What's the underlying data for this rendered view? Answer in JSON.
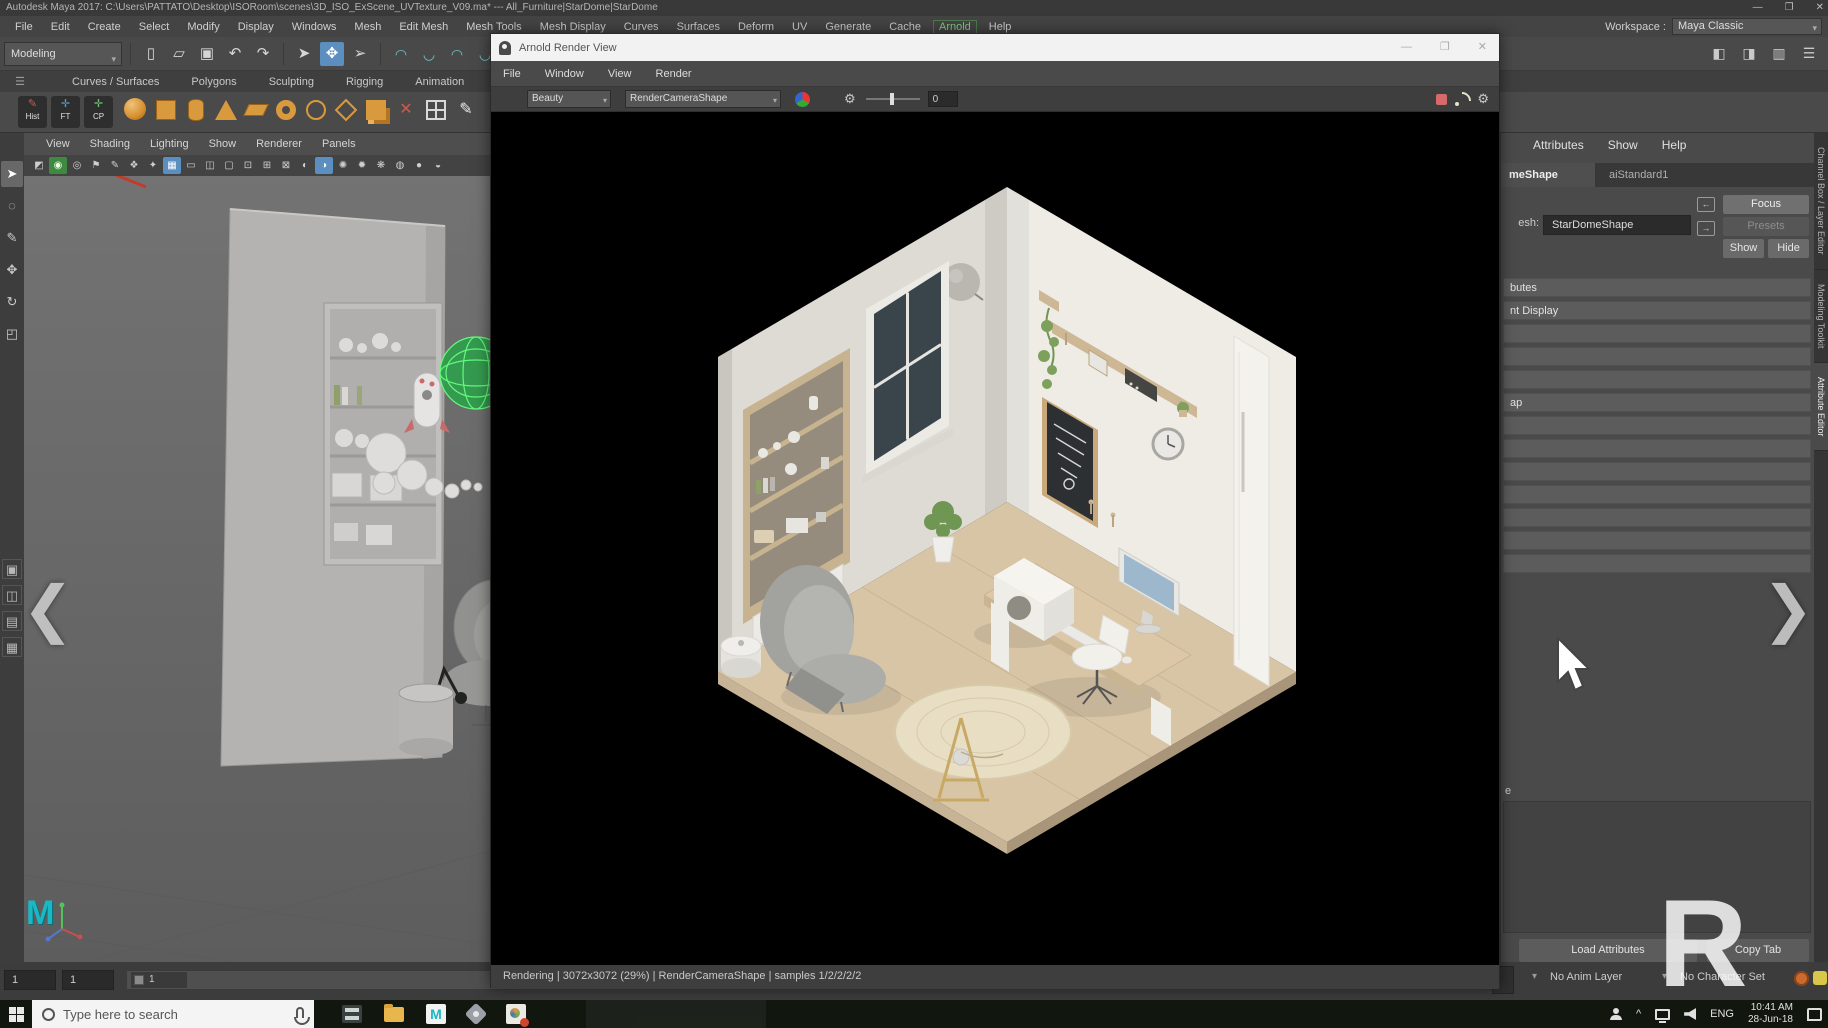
{
  "titlebar": {
    "title": "Autodesk Maya 2017: C:\\Users\\PATTATO\\Desktop\\ISORoom\\scenes\\3D_ISO_ExScene_UVTexture_V09.ma*  ---  All_Furniture|StarDome|StarDome",
    "minimize": "—",
    "maximize": "❐",
    "close": "✕"
  },
  "menubar": {
    "items": [
      "File",
      "Edit",
      "Create",
      "Select",
      "Modify",
      "Display",
      "Windows",
      "Mesh",
      "Edit Mesh",
      "Mesh Tools",
      "Mesh Display",
      "Curves",
      "Surfaces",
      "Deform",
      "UV",
      "Generate",
      "Cache",
      "Arnold",
      "Help"
    ],
    "workspace_label": "Workspace :",
    "workspace_value": "Maya Classic",
    "dropdown_arrow": "▾"
  },
  "toolbar": {
    "mode": "Modeling",
    "file_glyphs": [
      "▯",
      "▱",
      "▣",
      "↶",
      "↷"
    ],
    "select_glyphs": [
      "➤",
      "✥",
      "➢"
    ],
    "snap_glyphs": [
      "◠",
      "◡",
      "◠",
      "◡",
      "◠",
      "◡"
    ],
    "right_glyphs": [
      "◧",
      "◨",
      "▥",
      "☰"
    ]
  },
  "shelf": {
    "burger": "☰",
    "tabs": [
      "Curves / Surfaces",
      "Polygons",
      "Sculpting",
      "Rigging",
      "Animation",
      "R</span>endering",
      "FX"
    ],
    "buttons": [
      {
        "label": "Hist",
        "glyph": "✎"
      },
      {
        "label": "FT",
        "glyph": "✛"
      },
      {
        "label": "CP",
        "glyph": "✛"
      }
    ],
    "x_glyph": "✕",
    "pencil_glyph": "✎"
  },
  "toolbox": {
    "tools": [
      "➤",
      "◌",
      "✎",
      "✥",
      "↻",
      "◰"
    ],
    "layouts": [
      "▣",
      "◫",
      "▤",
      "▦"
    ]
  },
  "viewport": {
    "menus": [
      "View",
      "Shading",
      "Lighting",
      "Show",
      "Renderer",
      "Panels"
    ],
    "icons": [
      "◩",
      "◉",
      "◎",
      "⚑",
      "✎",
      "❖",
      "✦",
      "▦",
      "▭",
      "◫",
      "▢",
      "⊡",
      "⊞",
      "⊠",
      "◐",
      "◑",
      "✺",
      "✹",
      "❋",
      "◍",
      "●",
      "◒"
    ]
  },
  "logos": {
    "maya": "M"
  },
  "render_view": {
    "title": "Arnold Render View",
    "minimize": "—",
    "maximize": "❐",
    "close": "✕",
    "menus": [
      "File",
      "Window",
      "View",
      "Render"
    ],
    "aov": "Beauty",
    "camera": "RenderCameraShape",
    "exposure": "0",
    "gear": "⚙",
    "status": "Rendering | 3072x3072 (29%) | RenderCameraShape  | samples 1/2/2/2/2"
  },
  "attribute_editor": {
    "menus": [
      "Attributes",
      "Show",
      "Help"
    ],
    "tab_shape": "meShape",
    "tab_shader": "aiStandard1",
    "mesh_label": "esh:",
    "mesh_value": "StarDomeShape",
    "icon_in": "←",
    "icon_out": "→",
    "focus": "Focus",
    "presets": "Presets",
    "show": "Show",
    "hide": "Hide",
    "sections": [
      "butes",
      "nt Display",
      "",
      "",
      "",
      "ap",
      "",
      "",
      "",
      "",
      "",
      "",
      ""
    ],
    "notes_fragment": "e",
    "load_attributes": "Load Attributes",
    "copy_tab": "Copy Tab",
    "side_tabs": [
      "Channel Box / Layer Editor",
      "Modeling Toolkit",
      "Attribute Editor"
    ]
  },
  "timeline": {
    "current_frame": "1",
    "start_frame": "1",
    "range_start": "1",
    "anim_layer": "No Anim Layer",
    "character_set": "No Character Set",
    "caret": "▾"
  },
  "taskbar": {
    "search_placeholder": "Type here to search",
    "tray_chevron": "^",
    "language": "ENG",
    "time": "10:41 AM",
    "date": "28-Jun-18"
  },
  "overlay": {
    "prev": "❮",
    "next": "❯",
    "watermark": "R"
  }
}
